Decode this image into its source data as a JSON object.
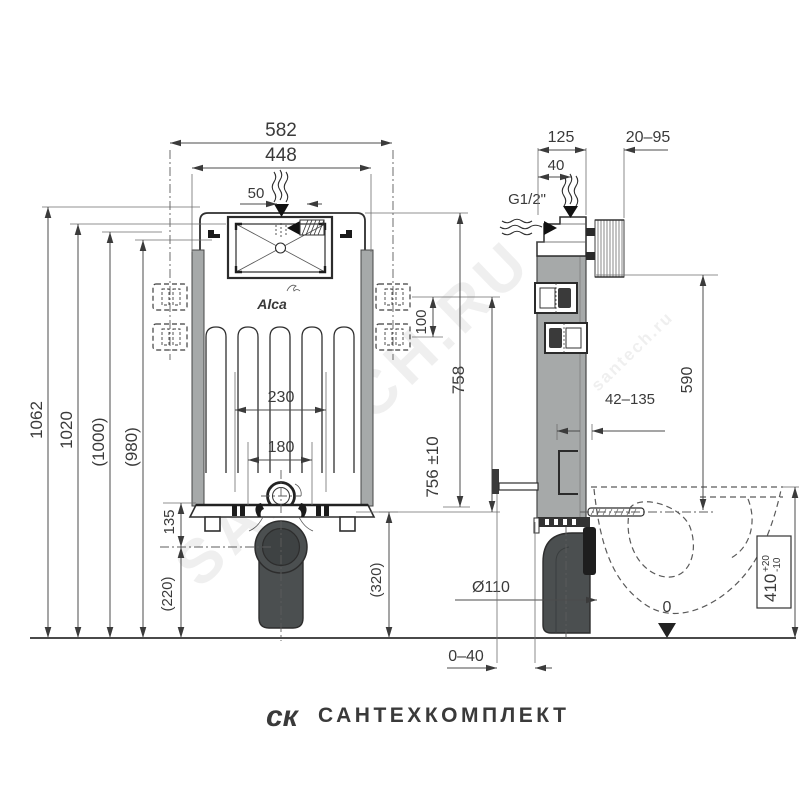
{
  "front": {
    "d582": "582",
    "d448": "448",
    "d50": "50",
    "d1062": "1062",
    "d1020": "1020",
    "d1000": "(1000)",
    "d980": "(980)",
    "d100": "100",
    "d758": "758",
    "d756": "756 ±10",
    "d230": "230",
    "d180": "180",
    "d135": "135",
    "d220": "(220)",
    "d320": "(320)"
  },
  "side": {
    "d125": "125",
    "d40": "40",
    "d2095": "20–95",
    "g12": "G1/2\"",
    "d42135": "42–135",
    "d590": "590",
    "dia": "Ø110",
    "d410": "410",
    "d410p": "+20",
    "d410m": "-10",
    "d040": "0–40",
    "zero": "0"
  },
  "brand": {
    "logo": "Alca"
  },
  "wm": {
    "diag": "SANTECH.RU",
    "diag2": "santech.ru",
    "logo": "ск",
    "name": "САНТЕХКОМПЛЕКТ"
  }
}
